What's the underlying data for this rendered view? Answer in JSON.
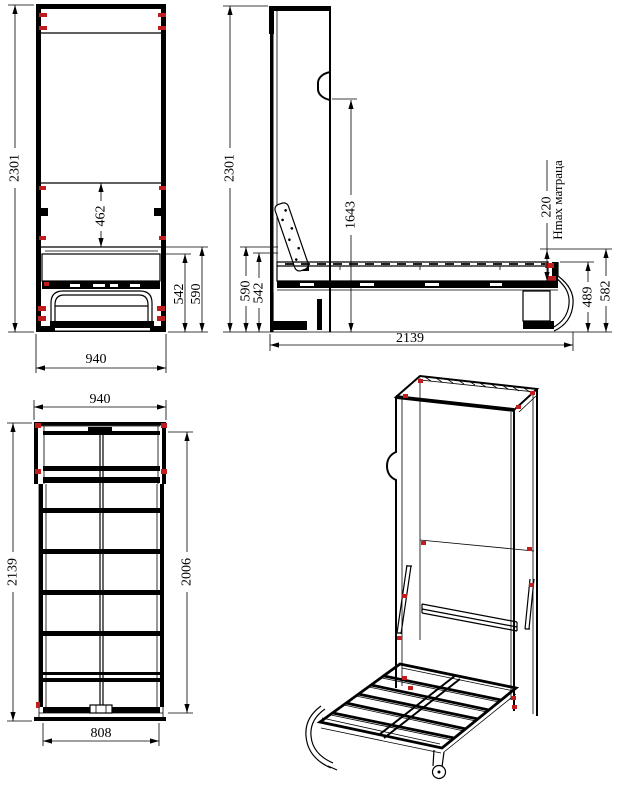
{
  "drawing": {
    "colors": {
      "line": "#000000",
      "marker_red": "#c01e1e",
      "background": "#ffffff"
    },
    "views": {
      "front": {
        "dims": {
          "height": "2301",
          "opening_height": "462",
          "bed_top_low": "542",
          "bed_top_high": "590",
          "width": "940"
        }
      },
      "side": {
        "dims": {
          "height": "2301",
          "bed_top_high": "590",
          "bed_top_low": "542",
          "handle_height": "1643",
          "mattress_max_height": "220",
          "mattress_note": "Hmax матраца",
          "platform_height": "489",
          "edge_height": "582",
          "length": "2139"
        }
      },
      "plan": {
        "dims": {
          "width": "940",
          "length": "2139",
          "frame_length": "2006",
          "frame_width": "808"
        }
      }
    }
  }
}
